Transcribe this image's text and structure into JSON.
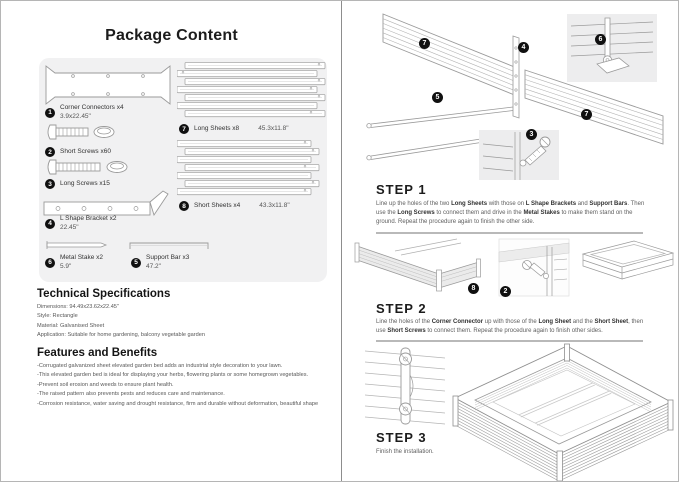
{
  "page": {
    "title": "Package Content"
  },
  "package": {
    "items": [
      {
        "num": "1",
        "label": "Corner Connectors x4",
        "size": "3.9x22.45\""
      },
      {
        "num": "2",
        "label": "Short Screws x60",
        "size": ""
      },
      {
        "num": "3",
        "label": "Long Screws x15",
        "size": ""
      },
      {
        "num": "4",
        "label": "L Shape Bracket x2",
        "size": "22.45\""
      },
      {
        "num": "5",
        "label": "Support Bar x3",
        "size": "47.2\""
      },
      {
        "num": "6",
        "label": "Metal Stake x2",
        "size": "5.9\""
      },
      {
        "num": "7",
        "label": "Long Sheets x8",
        "size": "45.3x11.8\""
      },
      {
        "num": "8",
        "label": "Short Sheets x4",
        "size": "43.3x11.8\""
      }
    ]
  },
  "specs": {
    "heading": "Technical Specifications",
    "lines": [
      "Dimensions: 94.49x23.62x22.45\"",
      "Style: Rectangle",
      "Material: Galvanised Sheet",
      "Application: Suitable for home gardening, balcony vegetable garden"
    ]
  },
  "features": {
    "heading": "Features and Benefits",
    "lines": [
      "-Corrugated galvanized sheet elevated garden bed adds an industrial style decoration to your lawn.",
      "-This elevated garden bed is ideal for displaying your herbs, flowering plants or some homegrown vegetables.",
      "-Prevent soil erosion and weeds to ensure plant health.",
      "-The raised pattern also prevents pests and reduces care and maintenance.",
      "-Corrosion resistance, water saving and drought resistance, firm and durable without deformation, beautiful shape"
    ]
  },
  "steps": [
    {
      "heading": "STEP 1",
      "segments": [
        {
          "t": "Line up the holes of the two "
        },
        {
          "t": "Long Sheets",
          "b": true
        },
        {
          "t": " with those on "
        },
        {
          "t": "L Shape Brackets",
          "b": true
        },
        {
          "t": " and "
        },
        {
          "t": "Support Bars",
          "b": true
        },
        {
          "t": ". Then use the "
        },
        {
          "t": "Long Screws",
          "b": true
        },
        {
          "t": " to connect them and drive in the "
        },
        {
          "t": "Metal Stakes",
          "b": true
        },
        {
          "t": " to make them stand on the ground. Repeat the procedure again to finish the other side."
        }
      ]
    },
    {
      "heading": "STEP 2",
      "segments": [
        {
          "t": "Line the holes of the "
        },
        {
          "t": "Corner Connector",
          "b": true
        },
        {
          "t": " up with those of the "
        },
        {
          "t": "Long Sheet",
          "b": true
        },
        {
          "t": " and the "
        },
        {
          "t": "Short Sheet",
          "b": true
        },
        {
          "t": ", then use "
        },
        {
          "t": "Short Screws",
          "b": true
        },
        {
          "t": " to connect them. Repeat the procedure again to finish other sides."
        }
      ]
    },
    {
      "heading": "STEP 3",
      "segments": [
        {
          "t": "Finish the installation."
        }
      ]
    }
  ],
  "badges": {
    "step1": [
      "7",
      "4",
      "6",
      "5",
      "7",
      "3"
    ],
    "step2": [
      "8",
      "2"
    ]
  },
  "colors": {
    "badge": "#111111",
    "panel_bg": "#f1f1f2",
    "line_art": "#9a9a9a",
    "divider": "#b9b9b9"
  }
}
